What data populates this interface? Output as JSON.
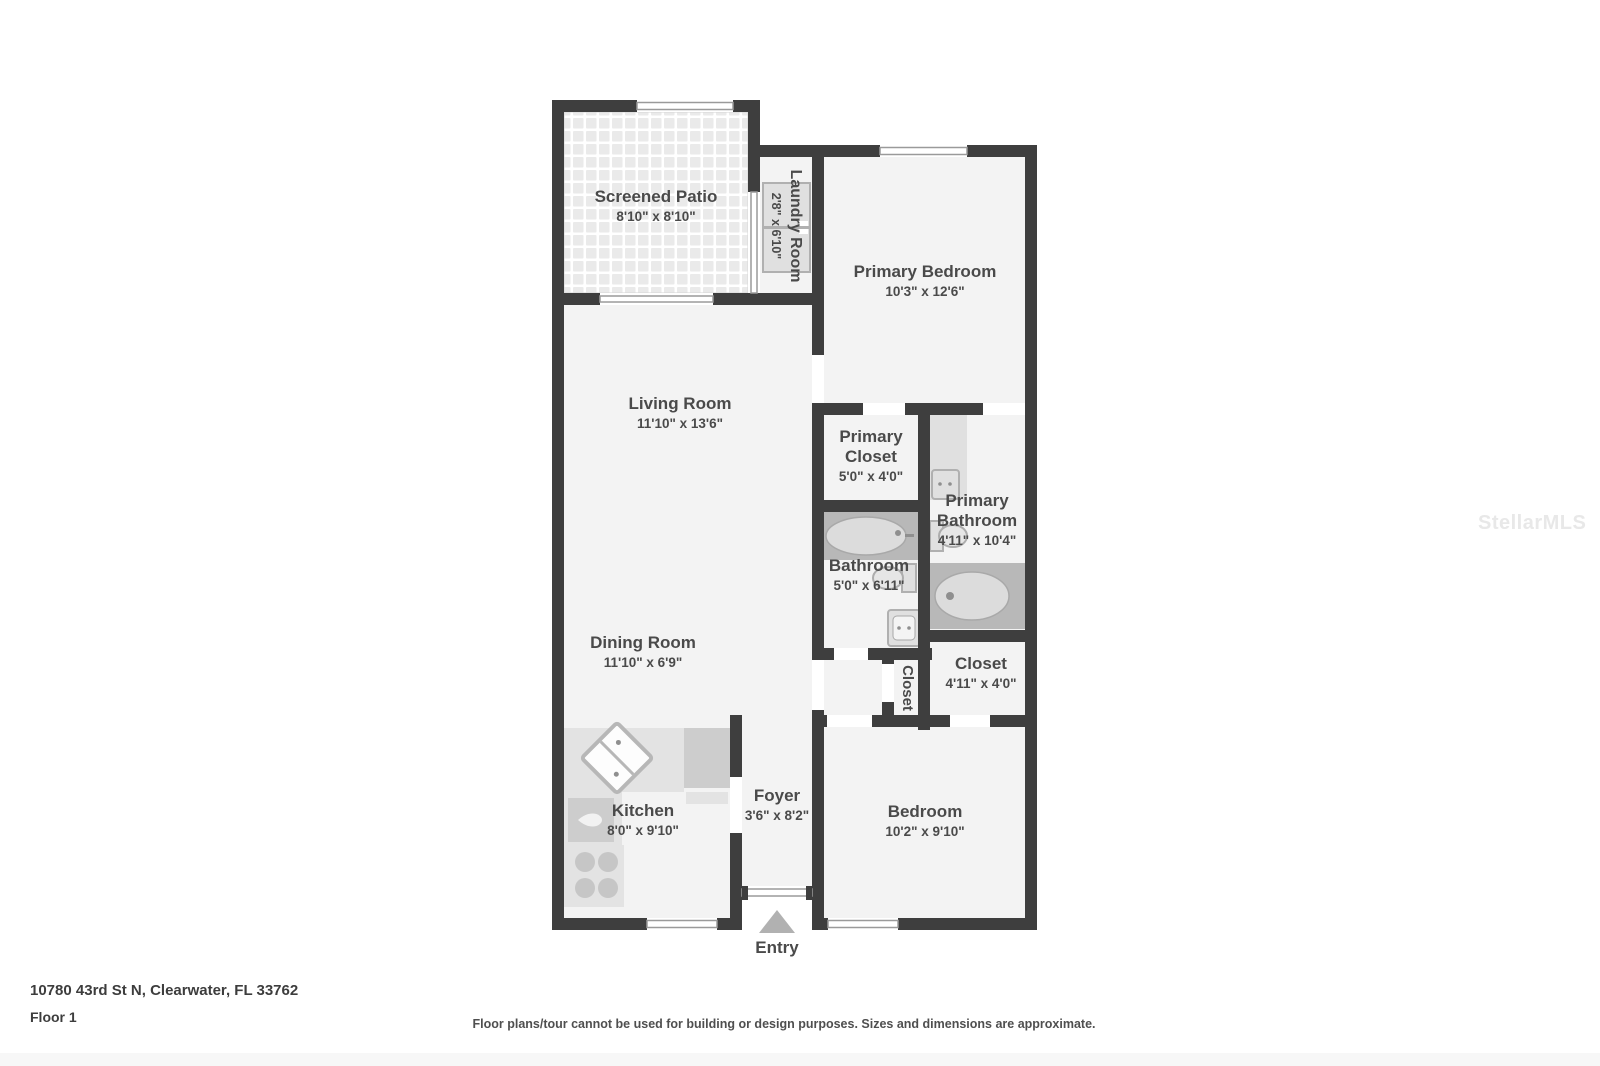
{
  "colors": {
    "wall": "#3e3e3e",
    "floor": "#f3f3f3",
    "text": "#4a4a4a",
    "surround": "#b8b8b8",
    "entry-arrow": "#b1b1b1",
    "watermark": "#e8e8e8"
  },
  "rooms": {
    "screened_patio": {
      "name": "Screened Patio",
      "dims": "8'10\" x 8'10\""
    },
    "laundry_room": {
      "name": "Laundry Room",
      "dims": "2'8\" x 6'10\""
    },
    "primary_bedroom": {
      "name": "Primary Bedroom",
      "dims": "10'3\" x 12'6\""
    },
    "living_room": {
      "name": "Living Room",
      "dims": "11'10\" x 13'6\""
    },
    "primary_closet": {
      "name": "Primary Closet",
      "dims": "5'0\" x 4'0\""
    },
    "primary_bathroom": {
      "name": "Primary Bathroom",
      "dims": "4'11\" x 10'4\""
    },
    "bathroom": {
      "name": "Bathroom",
      "dims": "5'0\" x 6'11\""
    },
    "dining_room": {
      "name": "Dining Room",
      "dims": "11'10\" x 6'9\""
    },
    "hall_closet": {
      "name": "Closet"
    },
    "bedroom_closet": {
      "name": "Closet",
      "dims": "4'11\" x 4'0\""
    },
    "kitchen": {
      "name": "Kitchen",
      "dims": "8'0\" x 9'10\""
    },
    "foyer": {
      "name": "Foyer",
      "dims": "3'6\" x 8'2\""
    },
    "bedroom": {
      "name": "Bedroom",
      "dims": "10'2\" x 9'10\""
    }
  },
  "entry_label": "Entry",
  "footer": {
    "address": "10780 43rd St N, Clearwater, FL 33762",
    "floor": "Floor 1",
    "disclaimer": "Floor plans/tour cannot be used for building or design purposes. Sizes and dimensions are approximate."
  },
  "watermark": "StellarMLS"
}
